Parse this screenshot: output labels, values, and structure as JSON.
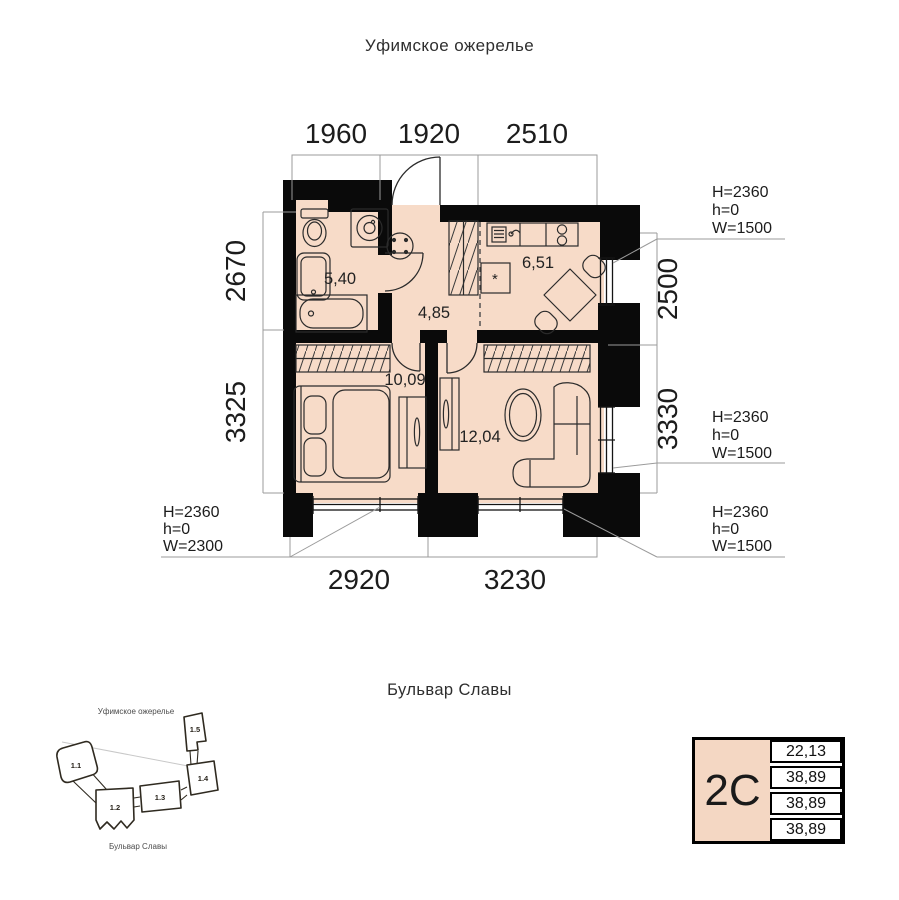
{
  "streets": {
    "top": "Уфимское ожерелье",
    "bottom": "Бульвар Славы"
  },
  "colors": {
    "floor": "#f7dbc8",
    "wall": "#0a0a0a",
    "minimap_highlight": "#c69a58",
    "card_fill": "#f4d7c3"
  },
  "plan": {
    "dims_top": [
      "1960",
      "1920",
      "2510"
    ],
    "dims_bottom": [
      "2920",
      "3230"
    ],
    "dims_left": [
      "2670",
      "3325"
    ],
    "dims_right": [
      "2500",
      "3330"
    ],
    "rooms": {
      "bathroom": "5,40",
      "hallway": "4,85",
      "kitchen": "6,51",
      "bedroom": "10,09",
      "living_room": "12,04"
    },
    "fridge_symbol": "*",
    "annotations": {
      "top_right": [
        "H=2360",
        "h=0",
        "W=1500"
      ],
      "mid_right": [
        "H=2360",
        "h=0",
        "W=1500"
      ],
      "bottom_left": [
        "H=2360",
        "h=0",
        "W=2300"
      ],
      "bottom_right": [
        "H=2360",
        "h=0",
        "W=1500"
      ]
    }
  },
  "minimap": {
    "street_top": "Уфимское ожерелье",
    "street_bottom": "Бульвар Славы",
    "buildings": [
      {
        "label": "1.1",
        "highlighted": true
      },
      {
        "label": "1.2",
        "highlighted": false
      },
      {
        "label": "1.3",
        "highlighted": false
      },
      {
        "label": "1.4",
        "highlighted": false
      },
      {
        "label": "1.5",
        "highlighted": false
      }
    ]
  },
  "unit_card": {
    "type": "2С",
    "values": [
      "22,13",
      "38,89",
      "38,89",
      "38,89"
    ]
  }
}
